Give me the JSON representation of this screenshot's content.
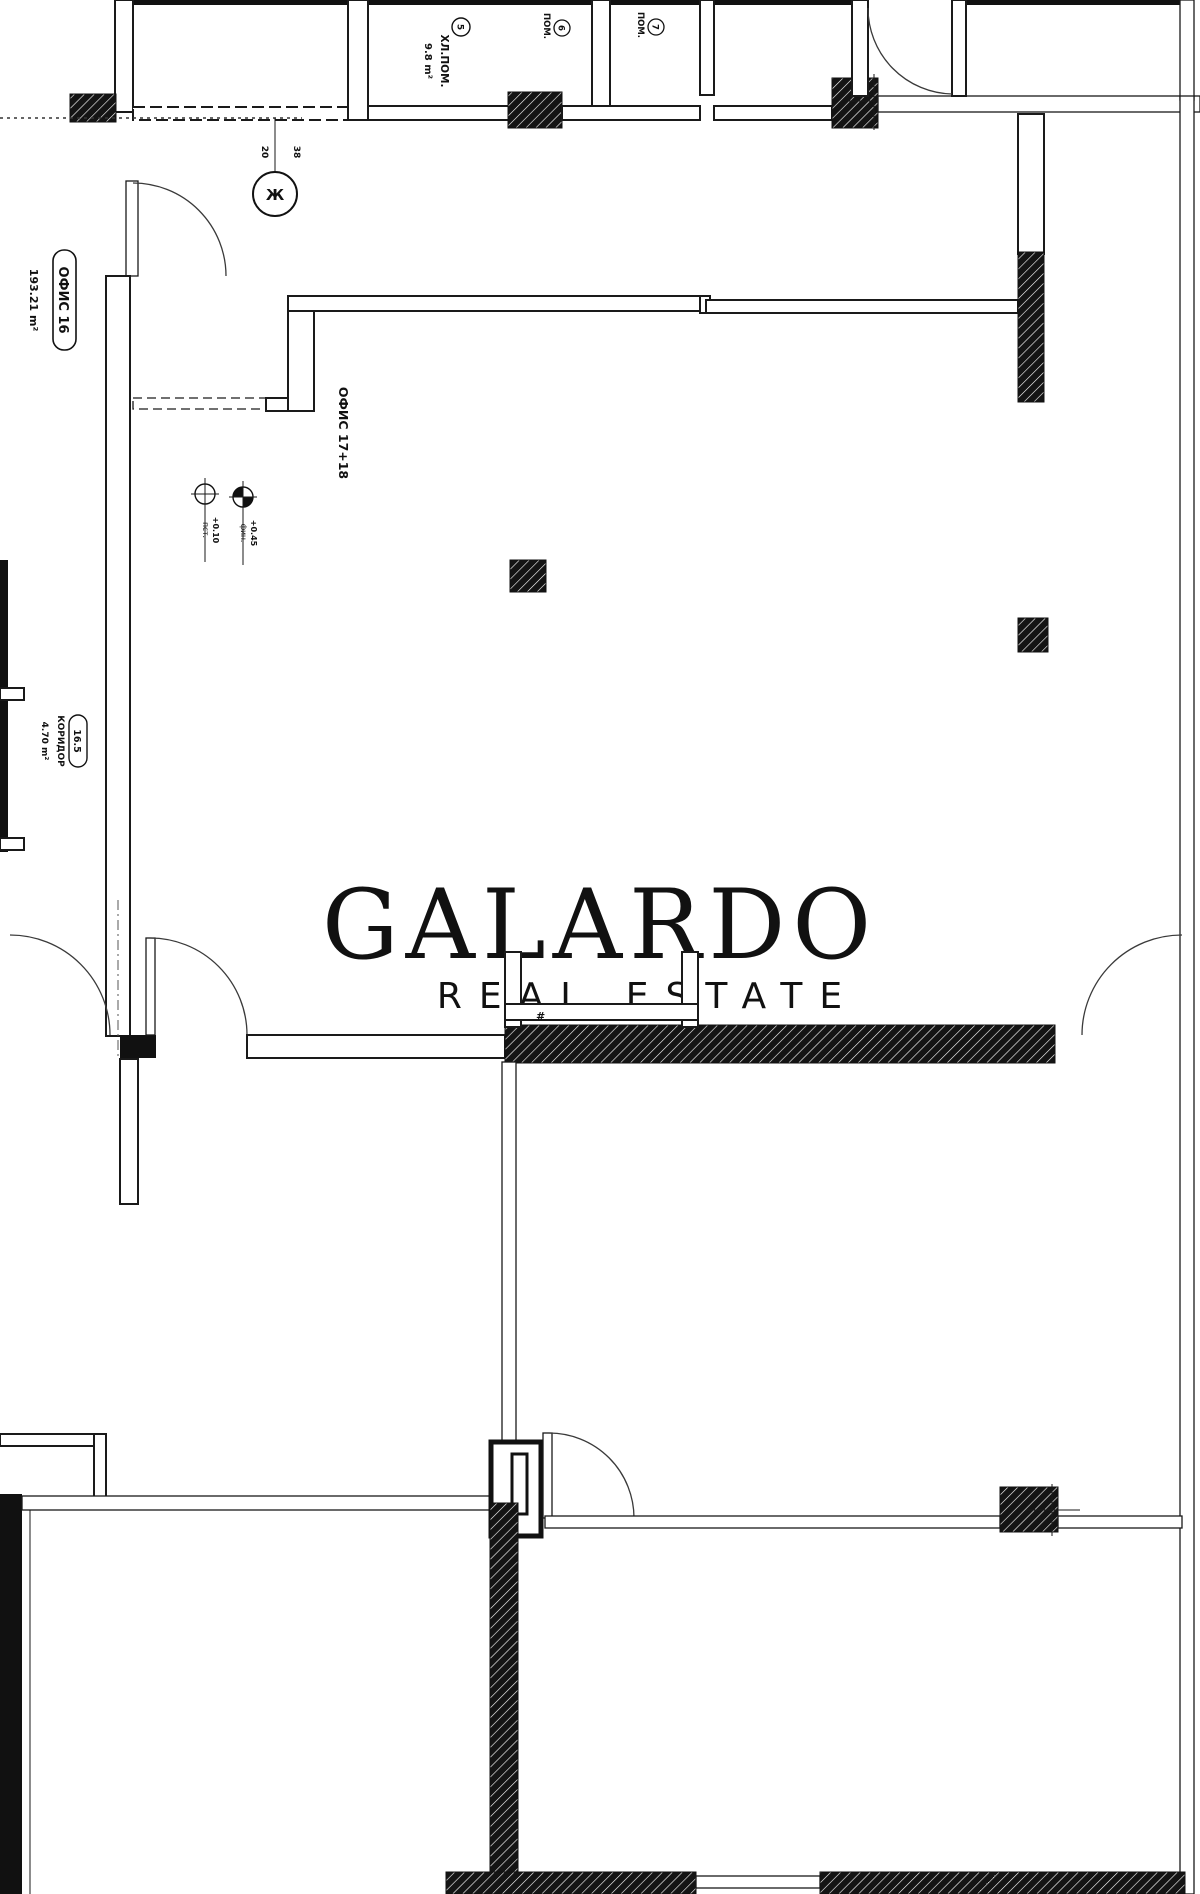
{
  "watermark": {
    "title": "GALARDO",
    "subtitle": "REAL ESTATE"
  },
  "labels": {
    "office16": {
      "name": "ОФИС 16",
      "area": "193.21 m²"
    },
    "office1718": {
      "name": "ОФИС 17+18"
    },
    "storeroom": {
      "tag": "5",
      "name": "ХЛ.ПОМ.",
      "area": "9.8 m²"
    },
    "room6": {
      "tag": "6",
      "name": "ПОМ."
    },
    "room7": {
      "tag": "7",
      "name": "ПОМ."
    },
    "corridor": {
      "tag": "16.5",
      "name": "КОРИДОР",
      "area": "4.70 m²"
    },
    "level_left": {
      "value": "+0.10",
      "note": "пст."
    },
    "level_right": {
      "value": "+0.45",
      "note": "фин."
    },
    "axis": {
      "bubble": "Ж",
      "dim_a": "20",
      "dim_b": "38"
    },
    "hash_mark": "#"
  },
  "colors": {
    "line": "#1a1a1a",
    "wall_fill": "#111111",
    "watermark": "#e8e9eb"
  }
}
